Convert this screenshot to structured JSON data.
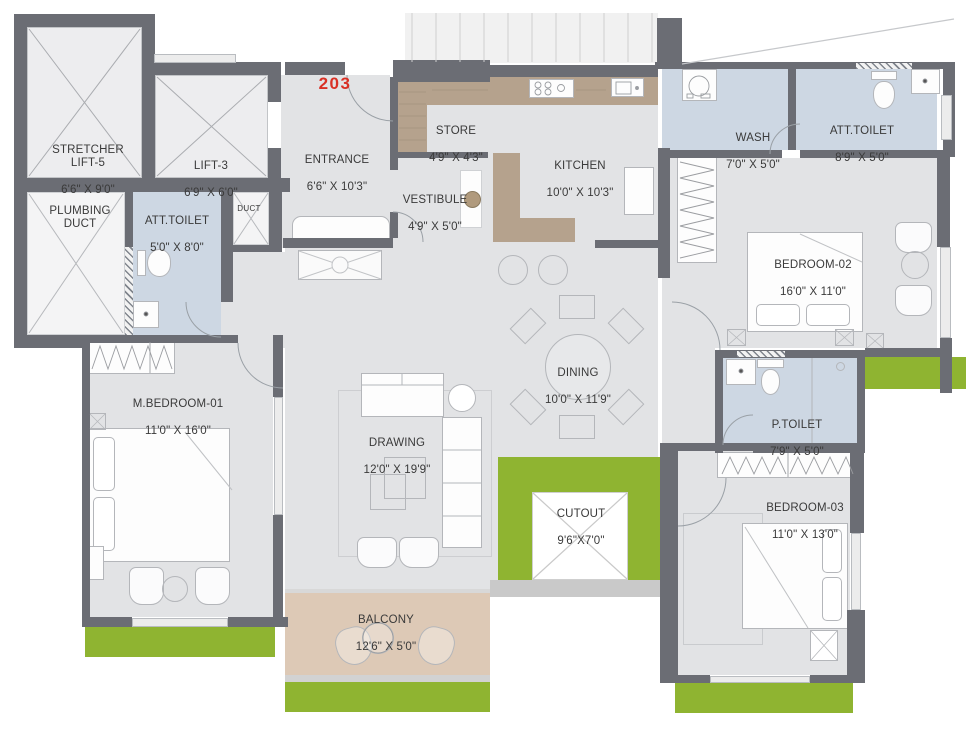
{
  "unit_number": "203",
  "rooms": {
    "stretcher_lift": {
      "name": "STRETCHER\nLIFT-5",
      "dims": "6'6\" X 9'0\""
    },
    "lift_3": {
      "name": "LIFT-3",
      "dims": "6'9\" X 6'0\""
    },
    "plumbing_duct": {
      "name": "PLUMBING\nDUCT",
      "dims": ""
    },
    "att_toilet_master": {
      "name": "ATT.TOILET",
      "dims": "5'0\" X 8'0\""
    },
    "duct": {
      "name": "DUCT",
      "dims": ""
    },
    "entrance": {
      "name": "ENTRANCE",
      "dims": "6'6\" X 10'3\""
    },
    "store": {
      "name": "STORE",
      "dims": "4'9\" X 4'3\""
    },
    "vestibule": {
      "name": "VESTIBULE",
      "dims": "4'9\" X 5'0\""
    },
    "kitchen": {
      "name": "KITCHEN",
      "dims": "10'0\" X 10'3\""
    },
    "wash": {
      "name": "WASH",
      "dims": "7'0\" X 5'0\""
    },
    "att_toilet_2": {
      "name": "ATT.TOILET",
      "dims": "8'9\" X 5'0\""
    },
    "bedroom_02": {
      "name": "BEDROOM-02",
      "dims": "16'0\" X 11'0\""
    },
    "dining": {
      "name": "DINING",
      "dims": "10'0\" X 11'9\""
    },
    "drawing": {
      "name": "DRAWING",
      "dims": "12'0\" X 19'9\""
    },
    "m_bedroom_01": {
      "name": "M.BEDROOM-01",
      "dims": "11'0\" X 16'0\""
    },
    "p_toilet": {
      "name": "P.TOILET",
      "dims": "7'9\" X 5'0\""
    },
    "bedroom_03": {
      "name": "BEDROOM-03",
      "dims": "11'0\" X 13'0\""
    },
    "cutout": {
      "name": "CUTOUT",
      "dims": "9'6\"X7'0\""
    },
    "balcony": {
      "name": "BALCONY",
      "dims": "12'6\" X 5'0\""
    }
  },
  "colors": {
    "wall": "#6b6d74",
    "floor": "#e2e3e5",
    "lift": "#ededef",
    "toilet_blue": "#cdd7e3",
    "counter_tan": "#b5a28d",
    "balcony_tan": "#ddc9b6",
    "green": "#8fb431",
    "stair": "#f1f1f1",
    "outline": "#b4b6ba",
    "text": "#3a3a3a",
    "unit_red": "#d93025",
    "window": "#ececec",
    "band": "#c9c9c9"
  }
}
